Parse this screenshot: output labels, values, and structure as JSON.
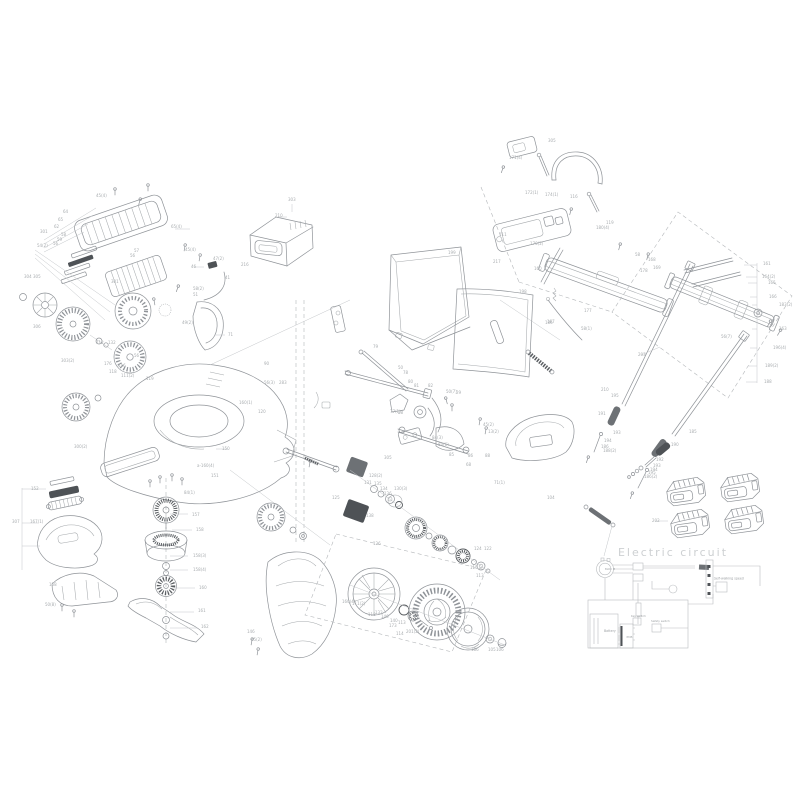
{
  "diagram": {
    "background": "#ffffff",
    "line_color": "#8f9398",
    "dark_color": "#55595d",
    "label_color": "#a9adb0",
    "title": "Electric circuit",
    "battery_pack_count": 4,
    "circuit": {
      "labels": [
        {
          "t": "BLDC M",
          "x": 605,
          "y": 570,
          "s": 2.6
        },
        {
          "t": "Battery",
          "x": 604,
          "y": 632,
          "s": 3.2
        },
        {
          "t": "PCB",
          "x": 626.5,
          "y": 638,
          "s": 3.0
        },
        {
          "t": "Key switch",
          "x": 631,
          "y": 617,
          "s": 2.8
        },
        {
          "t": "Safety switch",
          "x": 651,
          "y": 622,
          "s": 2.8
        },
        {
          "t": "Self-walking speed",
          "x": 714,
          "y": 579.5,
          "s": 3.2
        }
      ]
    },
    "part_labels": [
      {
        "t": "45(4)",
        "x": 96,
        "y": 197
      },
      {
        "t": "64",
        "x": 63,
        "y": 213
      },
      {
        "t": "65",
        "x": 58,
        "y": 221
      },
      {
        "t": "62",
        "x": 54,
        "y": 228
      },
      {
        "t": "301",
        "x": 40,
        "y": 233
      },
      {
        "t": "58",
        "x": 61,
        "y": 236
      },
      {
        "t": "59",
        "x": 57,
        "y": 241
      },
      {
        "t": "56",
        "x": 53,
        "y": 245
      },
      {
        "t": "54(2)",
        "x": 37,
        "y": 247
      },
      {
        "t": "65(4)",
        "x": 171,
        "y": 228
      },
      {
        "t": "45(4)",
        "x": 185,
        "y": 251
      },
      {
        "t": "47(2)",
        "x": 213,
        "y": 260
      },
      {
        "t": "216",
        "x": 241,
        "y": 266
      },
      {
        "t": "46",
        "x": 191,
        "y": 268
      },
      {
        "t": "41",
        "x": 225,
        "y": 279
      },
      {
        "t": "301",
        "x": 111,
        "y": 283
      },
      {
        "t": "58(2)",
        "x": 193,
        "y": 290
      },
      {
        "t": "51",
        "x": 193,
        "y": 296
      },
      {
        "t": "57",
        "x": 134,
        "y": 252
      },
      {
        "t": "56",
        "x": 130,
        "y": 257
      },
      {
        "t": "304",
        "x": 24,
        "y": 278
      },
      {
        "t": "305",
        "x": 33,
        "y": 278
      },
      {
        "t": "306",
        "x": 33,
        "y": 328
      },
      {
        "t": "303(2)",
        "x": 61,
        "y": 362
      },
      {
        "t": "71",
        "x": 228,
        "y": 336
      },
      {
        "t": "49(2)",
        "x": 182,
        "y": 324
      },
      {
        "t": "303",
        "x": 288,
        "y": 201
      },
      {
        "t": "210",
        "x": 275,
        "y": 217
      },
      {
        "t": "112",
        "x": 96,
        "y": 344
      },
      {
        "t": "132",
        "x": 108,
        "y": 344
      },
      {
        "t": "176",
        "x": 104,
        "y": 365
      },
      {
        "t": "116",
        "x": 118,
        "y": 367
      },
      {
        "t": "118",
        "x": 109,
        "y": 373
      },
      {
        "t": "111(2)",
        "x": 121,
        "y": 377
      },
      {
        "t": "119",
        "x": 146,
        "y": 380
      },
      {
        "t": "56",
        "x": 134,
        "y": 357
      },
      {
        "t": "90",
        "x": 264,
        "y": 365
      },
      {
        "t": "56(3)",
        "x": 264,
        "y": 384
      },
      {
        "t": "283",
        "x": 279,
        "y": 384
      },
      {
        "t": "160(1)",
        "x": 239,
        "y": 404
      },
      {
        "t": "120",
        "x": 258,
        "y": 413
      },
      {
        "t": "150",
        "x": 222,
        "y": 450
      },
      {
        "t": "a-160(4)",
        "x": 197,
        "y": 467
      },
      {
        "t": "151",
        "x": 211,
        "y": 477
      },
      {
        "t": "300(2)",
        "x": 74,
        "y": 448
      },
      {
        "t": "152",
        "x": 31,
        "y": 490
      },
      {
        "t": "307",
        "x": 12,
        "y": 523
      },
      {
        "t": "167(1)",
        "x": 30,
        "y": 523
      },
      {
        "t": "158",
        "x": 49,
        "y": 586
      },
      {
        "t": "50(8)",
        "x": 45,
        "y": 606
      },
      {
        "t": "84(1)",
        "x": 184,
        "y": 494
      },
      {
        "t": "157",
        "x": 192,
        "y": 516
      },
      {
        "t": "158",
        "x": 196,
        "y": 531
      },
      {
        "t": "158(3)",
        "x": 193,
        "y": 557
      },
      {
        "t": "158(4)",
        "x": 193,
        "y": 571
      },
      {
        "t": "160",
        "x": 199,
        "y": 589
      },
      {
        "t": "161",
        "x": 198,
        "y": 612
      },
      {
        "t": "162",
        "x": 201,
        "y": 628
      },
      {
        "t": "146",
        "x": 247,
        "y": 633
      },
      {
        "t": "45(2)",
        "x": 251,
        "y": 641
      },
      {
        "t": "305",
        "x": 384,
        "y": 459
      },
      {
        "t": "85",
        "x": 449,
        "y": 456
      },
      {
        "t": "86",
        "x": 468,
        "y": 457
      },
      {
        "t": "88",
        "x": 485,
        "y": 457
      },
      {
        "t": "84(3)",
        "x": 432,
        "y": 439
      },
      {
        "t": "84(6)",
        "x": 438,
        "y": 446
      },
      {
        "t": "45(2)",
        "x": 483,
        "y": 426
      },
      {
        "t": "13(2)",
        "x": 488,
        "y": 433
      },
      {
        "t": "199",
        "x": 448,
        "y": 254
      },
      {
        "t": "217",
        "x": 493,
        "y": 263
      },
      {
        "t": "198",
        "x": 519,
        "y": 293
      },
      {
        "t": "186",
        "x": 545,
        "y": 324
      },
      {
        "t": "79",
        "x": 373,
        "y": 348
      },
      {
        "t": "50",
        "x": 398,
        "y": 369
      },
      {
        "t": "78",
        "x": 403,
        "y": 374
      },
      {
        "t": "80",
        "x": 408,
        "y": 383
      },
      {
        "t": "81",
        "x": 414,
        "y": 387
      },
      {
        "t": "82",
        "x": 428,
        "y": 387
      },
      {
        "t": "50(7)",
        "x": 446,
        "y": 393
      },
      {
        "t": "29",
        "x": 456,
        "y": 394
      },
      {
        "t": "77(1)",
        "x": 390,
        "y": 413
      },
      {
        "t": "28",
        "x": 398,
        "y": 414
      },
      {
        "t": "68",
        "x": 466,
        "y": 466
      },
      {
        "t": "71(1)",
        "x": 494,
        "y": 484
      },
      {
        "t": "104",
        "x": 547,
        "y": 499
      },
      {
        "t": "128(2)",
        "x": 369,
        "y": 477
      },
      {
        "t": "131",
        "x": 364,
        "y": 484
      },
      {
        "t": "135",
        "x": 374,
        "y": 485
      },
      {
        "t": "134",
        "x": 380,
        "y": 490
      },
      {
        "t": "136",
        "x": 384,
        "y": 495
      },
      {
        "t": "130(3)",
        "x": 394,
        "y": 490
      },
      {
        "t": "125",
        "x": 332,
        "y": 499
      },
      {
        "t": "138",
        "x": 366,
        "y": 517
      },
      {
        "t": "126",
        "x": 373,
        "y": 545
      },
      {
        "t": "124",
        "x": 474,
        "y": 550
      },
      {
        "t": "122",
        "x": 484,
        "y": 550
      },
      {
        "t": "115",
        "x": 470,
        "y": 569
      },
      {
        "t": "113",
        "x": 476,
        "y": 577
      },
      {
        "t": "160(4)",
        "x": 342,
        "y": 603
      },
      {
        "t": "111(2)",
        "x": 352,
        "y": 605
      },
      {
        "t": "118",
        "x": 368,
        "y": 616
      },
      {
        "t": "132",
        "x": 375,
        "y": 614
      },
      {
        "t": "146",
        "x": 381,
        "y": 618
      },
      {
        "t": "140",
        "x": 390,
        "y": 622
      },
      {
        "t": "173",
        "x": 389,
        "y": 627
      },
      {
        "t": "113",
        "x": 398,
        "y": 624
      },
      {
        "t": "114",
        "x": 396,
        "y": 635
      },
      {
        "t": "201(2)",
        "x": 406,
        "y": 633
      },
      {
        "t": "186",
        "x": 471,
        "y": 651
      },
      {
        "t": "105",
        "x": 488,
        "y": 651
      },
      {
        "t": "106",
        "x": 496,
        "y": 651
      },
      {
        "t": "305",
        "x": 548,
        "y": 142
      },
      {
        "t": "171(4)",
        "x": 509,
        "y": 159
      },
      {
        "t": "172(1)",
        "x": 525,
        "y": 194
      },
      {
        "t": "174(1)",
        "x": 545,
        "y": 196
      },
      {
        "t": "116",
        "x": 570,
        "y": 198
      },
      {
        "t": "111",
        "x": 499,
        "y": 236
      },
      {
        "t": "170(2)",
        "x": 530,
        "y": 245
      },
      {
        "t": "119",
        "x": 606,
        "y": 224
      },
      {
        "t": "180(4)",
        "x": 596,
        "y": 229
      },
      {
        "t": "160",
        "x": 534,
        "y": 270
      },
      {
        "t": "58",
        "x": 635,
        "y": 256
      },
      {
        "t": "168",
        "x": 648,
        "y": 261
      },
      {
        "t": "169",
        "x": 653,
        "y": 269
      },
      {
        "t": "178",
        "x": 640,
        "y": 272
      },
      {
        "t": "177",
        "x": 584,
        "y": 312
      },
      {
        "t": "58(1)",
        "x": 581,
        "y": 330
      },
      {
        "t": "167",
        "x": 547,
        "y": 323
      },
      {
        "t": "161",
        "x": 763,
        "y": 265
      },
      {
        "t": "164(2)",
        "x": 762,
        "y": 278
      },
      {
        "t": "165",
        "x": 768,
        "y": 284
      },
      {
        "t": "166",
        "x": 769,
        "y": 298
      },
      {
        "t": "183(2)",
        "x": 779,
        "y": 306
      },
      {
        "t": "163",
        "x": 779,
        "y": 330
      },
      {
        "t": "196(4)",
        "x": 773,
        "y": 349
      },
      {
        "t": "189(2)",
        "x": 765,
        "y": 367
      },
      {
        "t": "188",
        "x": 764,
        "y": 383
      },
      {
        "t": "56(7)",
        "x": 721,
        "y": 338
      },
      {
        "t": "203",
        "x": 638,
        "y": 356
      },
      {
        "t": "185",
        "x": 689,
        "y": 433
      },
      {
        "t": "190",
        "x": 671,
        "y": 446
      },
      {
        "t": "192",
        "x": 656,
        "y": 461
      },
      {
        "t": "210",
        "x": 601,
        "y": 391
      },
      {
        "t": "195",
        "x": 611,
        "y": 397
      },
      {
        "t": "191",
        "x": 598,
        "y": 415
      },
      {
        "t": "193",
        "x": 613,
        "y": 434
      },
      {
        "t": "194",
        "x": 604,
        "y": 442
      },
      {
        "t": "186",
        "x": 601,
        "y": 448
      },
      {
        "t": "188(2)",
        "x": 603,
        "y": 452
      },
      {
        "t": "193",
        "x": 653,
        "y": 467
      },
      {
        "t": "194",
        "x": 650,
        "y": 471
      },
      {
        "t": "195",
        "x": 648,
        "y": 474
      },
      {
        "t": "186(2)",
        "x": 644,
        "y": 478
      },
      {
        "t": "202",
        "x": 652,
        "y": 522
      }
    ]
  }
}
